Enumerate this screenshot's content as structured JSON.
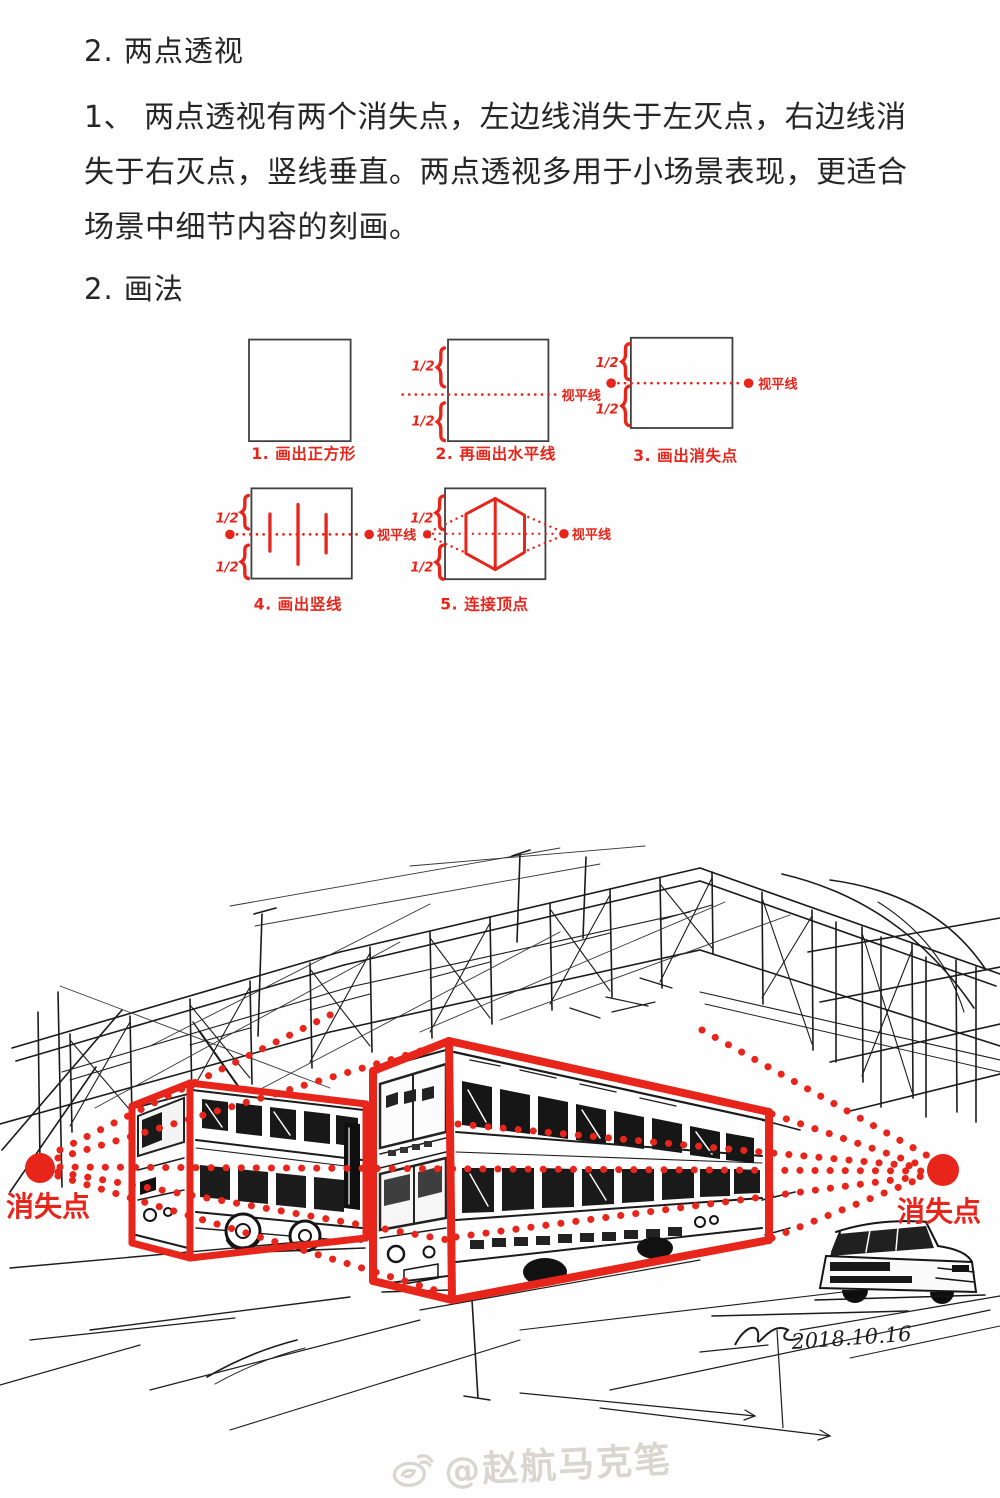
{
  "colors": {
    "accent_red": "#e8251b",
    "ink": "#171717",
    "text": "#262626",
    "watermark": "#d9d5cf"
  },
  "header": {
    "title": "2. 两点透视",
    "paragraph": "1、 两点透视有两个消失点，左边线消失于左灭点，右边线消\n失于右灭点，竖线垂直。两点透视多用于小场景表现，更适合\n场景中细节内容的刻画。",
    "method_heading": "2. 画法"
  },
  "labels": {
    "half": "1/2",
    "horizon": "视平线",
    "vanishing_point": "消失点"
  },
  "steps": [
    {
      "caption": "1. 画出正方形"
    },
    {
      "caption": "2. 再画出水平线"
    },
    {
      "caption": "3. 画出消失点"
    },
    {
      "caption": "4. 画出竖线"
    },
    {
      "caption": "5. 连接顶点"
    }
  ],
  "sketch": {
    "vanishing_point_left": "消失点",
    "vanishing_point_right": "消失点",
    "signature_date": "2018.10.16",
    "watermark": "@赵航马克笔"
  }
}
